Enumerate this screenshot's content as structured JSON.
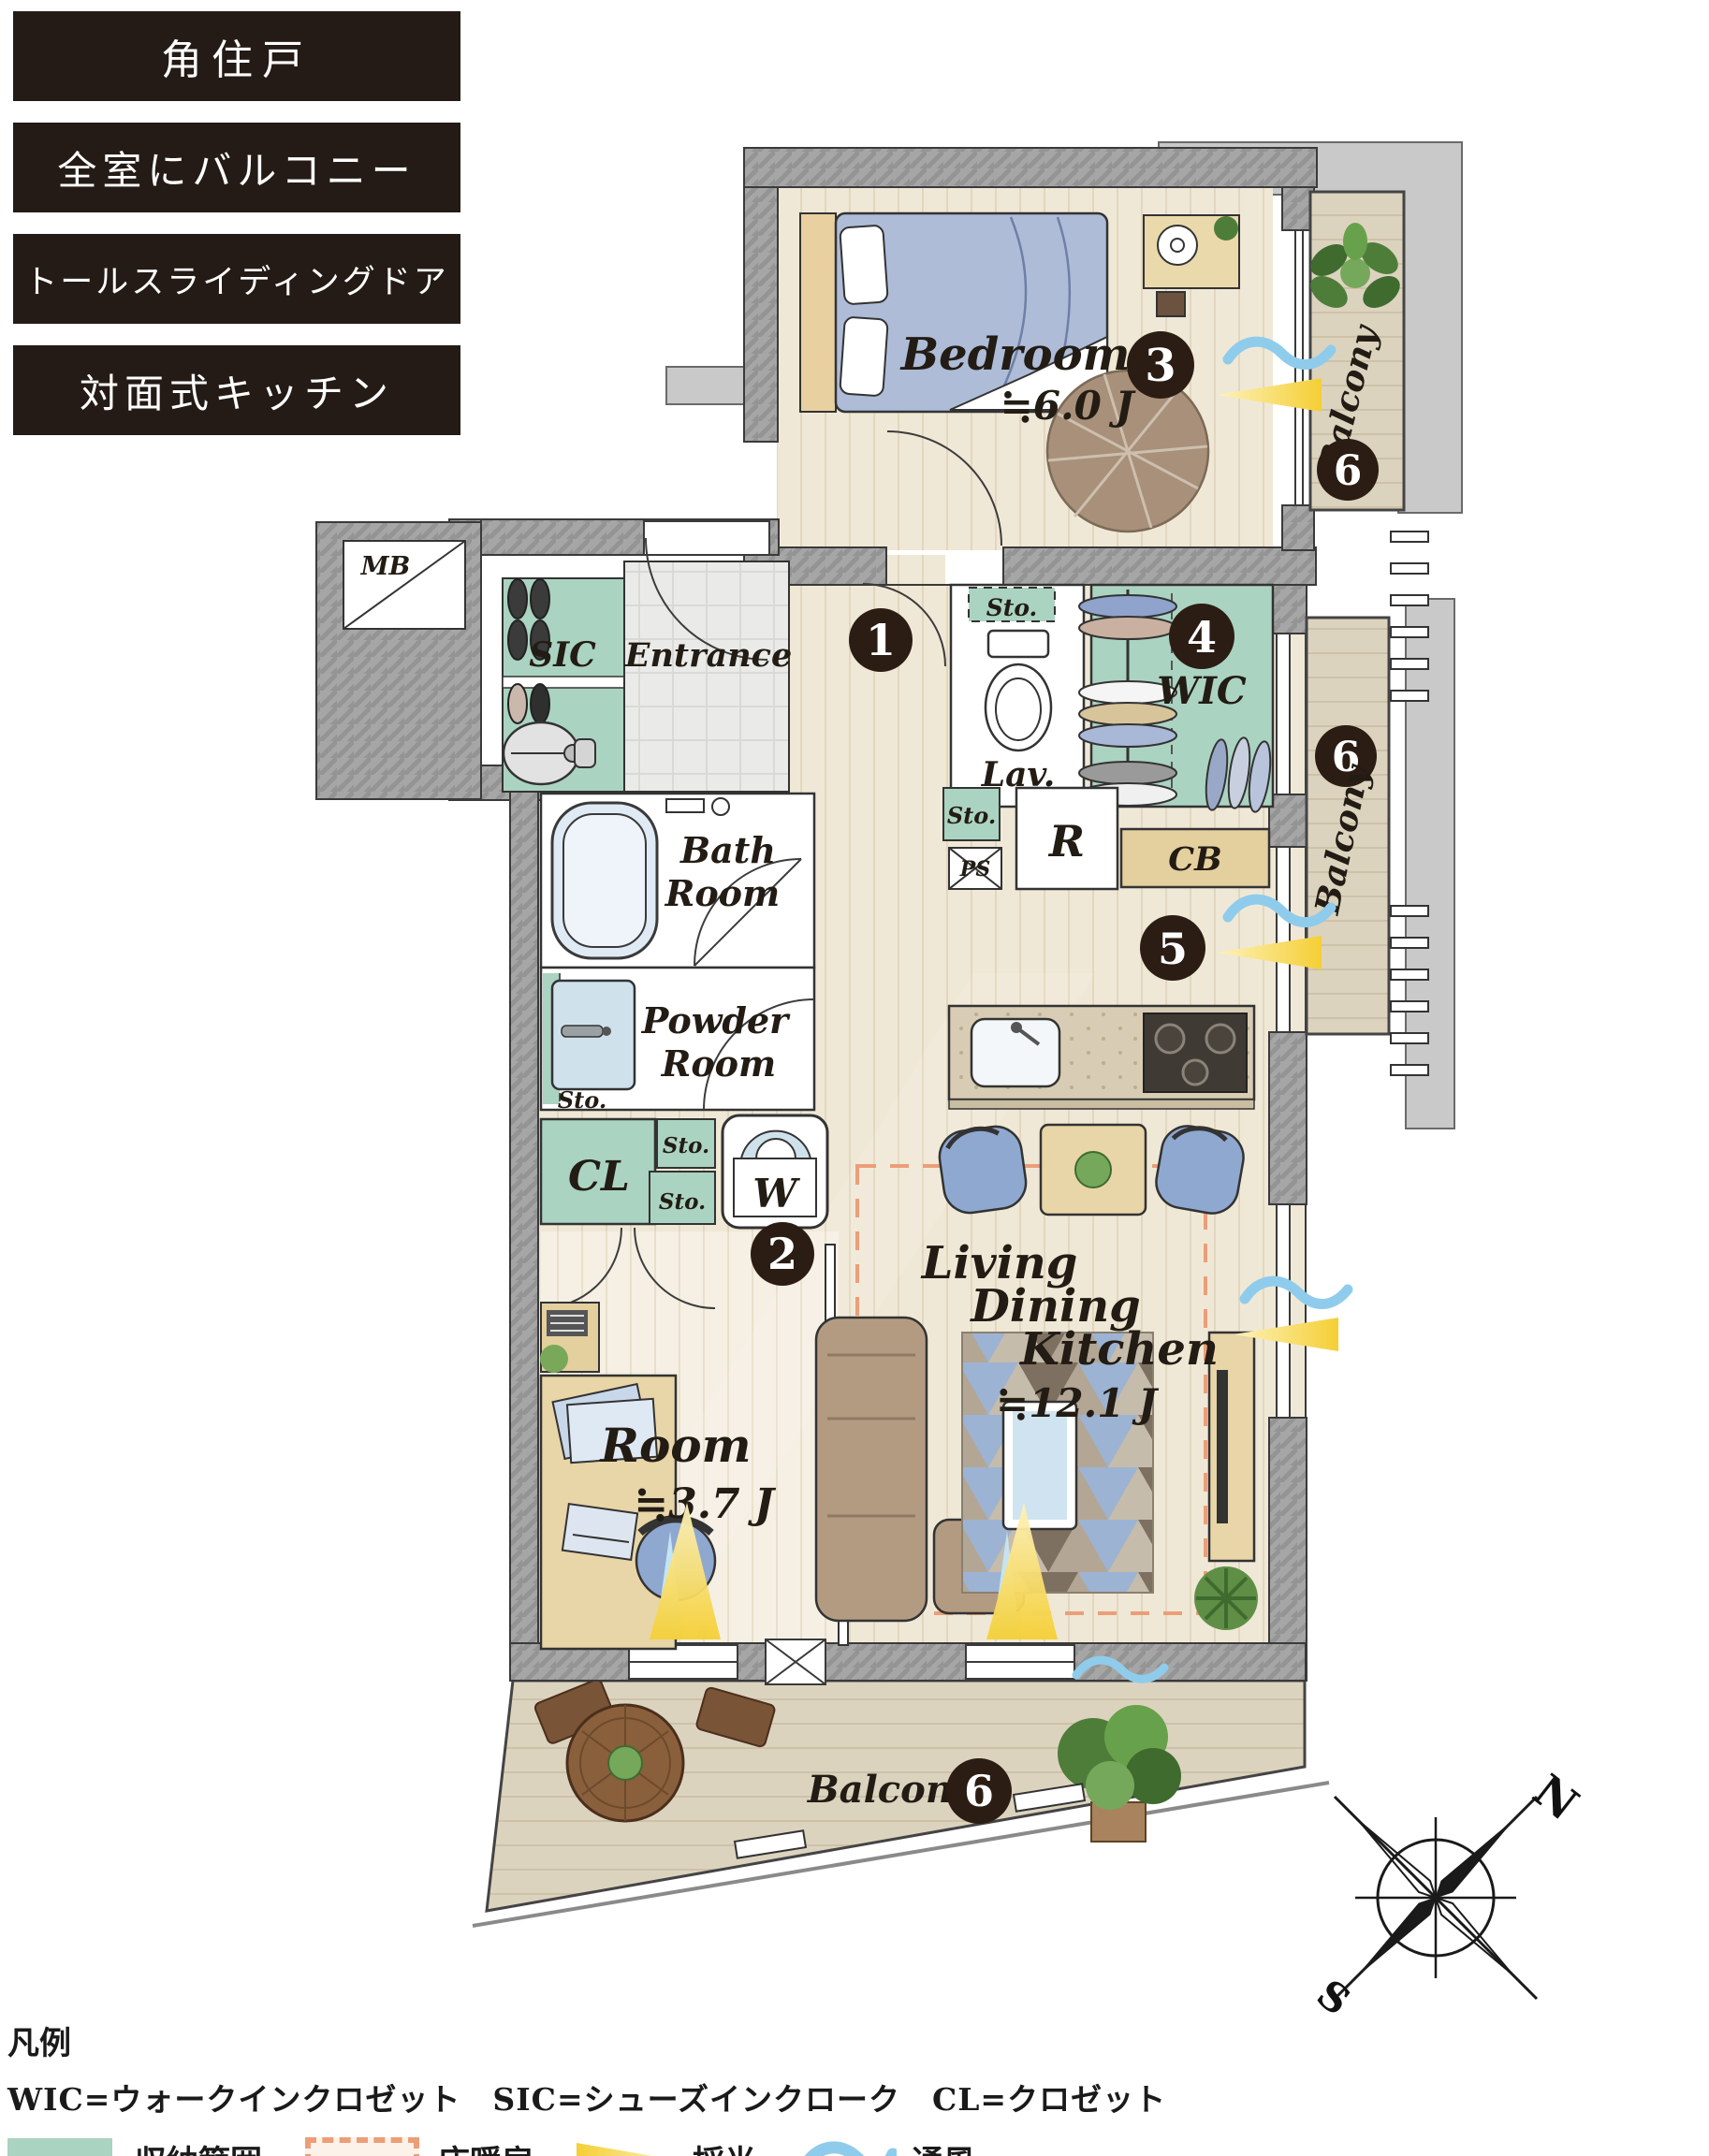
{
  "features": [
    "角住戸",
    "全室にバルコニー",
    "トールスライディングドア",
    "対面式キッチン"
  ],
  "plan": {
    "bedroom": {
      "label": "Bedroom",
      "size": "≒6.0 J"
    },
    "room": {
      "label": "Room",
      "size": "≒3.7 J"
    },
    "ldk": {
      "l1": "Living",
      "l2": "Dining",
      "l3": "Kitchen",
      "size": "≒12.1 J"
    },
    "entrance": "Entrance",
    "sic": "SIC",
    "mb": "MB",
    "lav": "Lav.",
    "wic": "WIC",
    "bath_l1": "Bath",
    "bath_l2": "Room",
    "powder_l1": "Powder",
    "powder_l2": "Room",
    "cl": "CL",
    "w": "W",
    "r": "R",
    "cb": "CB",
    "ps": "PS",
    "sto": "Sto.",
    "balcony": "Balcony",
    "badges": {
      "hall": "1",
      "room": "2",
      "bedroom": "3",
      "wic": "4",
      "ldk": "5",
      "balcony": "6"
    },
    "compass": {
      "n": "N",
      "s": "S"
    }
  },
  "legend": {
    "title": "凡例",
    "abbr": "WIC=ウォークインクロゼット　SIC=シューズインクローク　CL=クロゼット",
    "items": [
      "収納範囲",
      "床暖房",
      "採光",
      "通風"
    ]
  },
  "colors": {
    "banner_bg": "#241b16",
    "badge_bg": "#2b1d14",
    "storage_green": "#abd3c1",
    "wall_gray": "#a6a6a6",
    "floor_wood": "#f0e8d6",
    "deck": "#dcd3bf",
    "heated_floor": "#ec9e78",
    "daylight": "#f6d44a",
    "ventilation": "#8fccec"
  }
}
